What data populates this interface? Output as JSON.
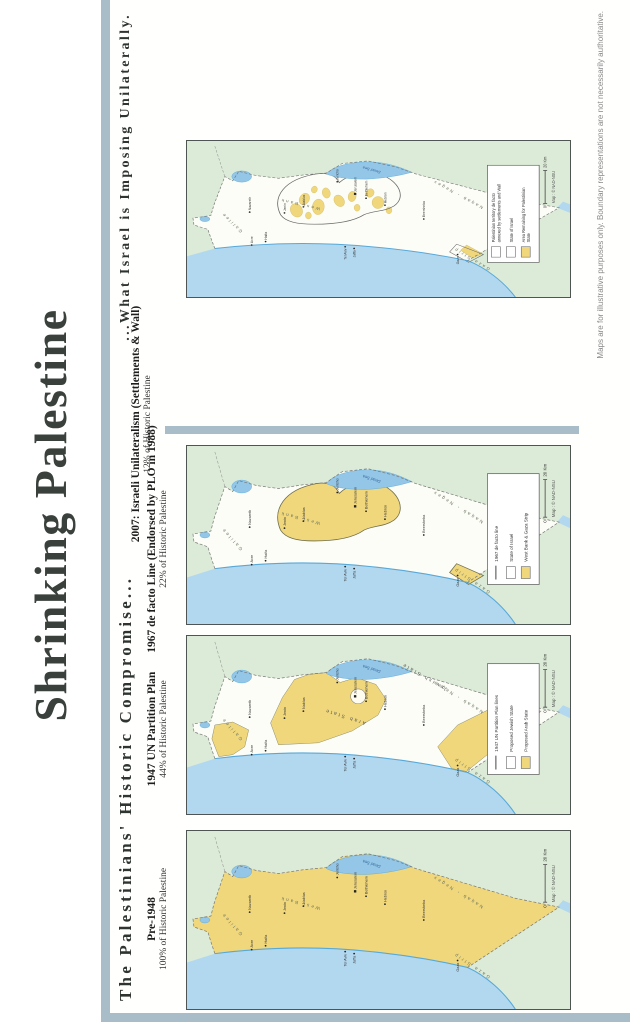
{
  "poster": {
    "title": "Shrinking Palestine",
    "heading_left": "The Palestinians' Historic Compromise...",
    "heading_right": "...What Israel is Imposing Unilaterally.",
    "disclaimer": "Maps are for illustrative purposes only. Boundary representations are not necessarily authoritative.",
    "credit": "Map : © NAD-NSU",
    "scale": {
      "zero": "0",
      "distance": "20 Km"
    },
    "colors": {
      "frame": "#a9bdc8",
      "sea": "#b2d8f0",
      "lake": "#93c6e7",
      "coast": "#58a8d8",
      "land_green": "#dcebd7",
      "palestine_yellow": "#f0d77b",
      "ink": "#333333"
    },
    "maps": [
      {
        "id": "pre1948",
        "title": "Pre-1948",
        "subtitle": "100% of Historic Palestine",
        "legend": []
      },
      {
        "id": "partition1947",
        "title": "1947 UN Partition Plan",
        "subtitle": "44% of Historic Palestine",
        "legend": [
          {
            "swatch": "line",
            "label": "1947 UN Partition Plan lines"
          },
          {
            "swatch": "white",
            "label": "Proposed Jewish State"
          },
          {
            "swatch": "yellow",
            "label": "Proposed Arab State"
          }
        ]
      },
      {
        "id": "defacto1967",
        "title": "1967 de facto Line (Endorsed by PLO in 1988)",
        "subtitle": "22% of Historic Palestine",
        "legend": [
          {
            "swatch": "line",
            "label": "1967 de facto line"
          },
          {
            "swatch": "white",
            "label": "State of Israel"
          },
          {
            "swatch": "yellow",
            "label": "West Bank & Gaza Strip"
          }
        ]
      },
      {
        "id": "unilateral2007",
        "title": "2007: Israeli Unilateralism (Settlements & Wall)",
        "subtitle": "12% of Historic Palestine",
        "legend": [
          {
            "swatch": "white",
            "label": "Palestinian territory de facto annexed by settlements and Wall"
          },
          {
            "swatch": "white",
            "label": "State of Israel"
          },
          {
            "swatch": "yellow",
            "label": "Area Remaining for Palestinian State"
          }
        ]
      }
    ],
    "map_labels": {
      "regions": [
        "Galilee",
        "West Bank",
        "Naqab - Negev",
        "Gaza Strip"
      ],
      "partition_states": [
        "Arab State",
        "Jewish State"
      ],
      "water": [
        "Dead Sea"
      ],
      "cities": [
        "Acre",
        "Haifa",
        "Nazareth",
        "Jenin",
        "Nablus",
        "Tel Aviv",
        "Jaffa",
        "Jericho",
        "Jerusalem",
        "Bethlehem",
        "Hebron",
        "Beersheba",
        "Gaza"
      ]
    }
  }
}
